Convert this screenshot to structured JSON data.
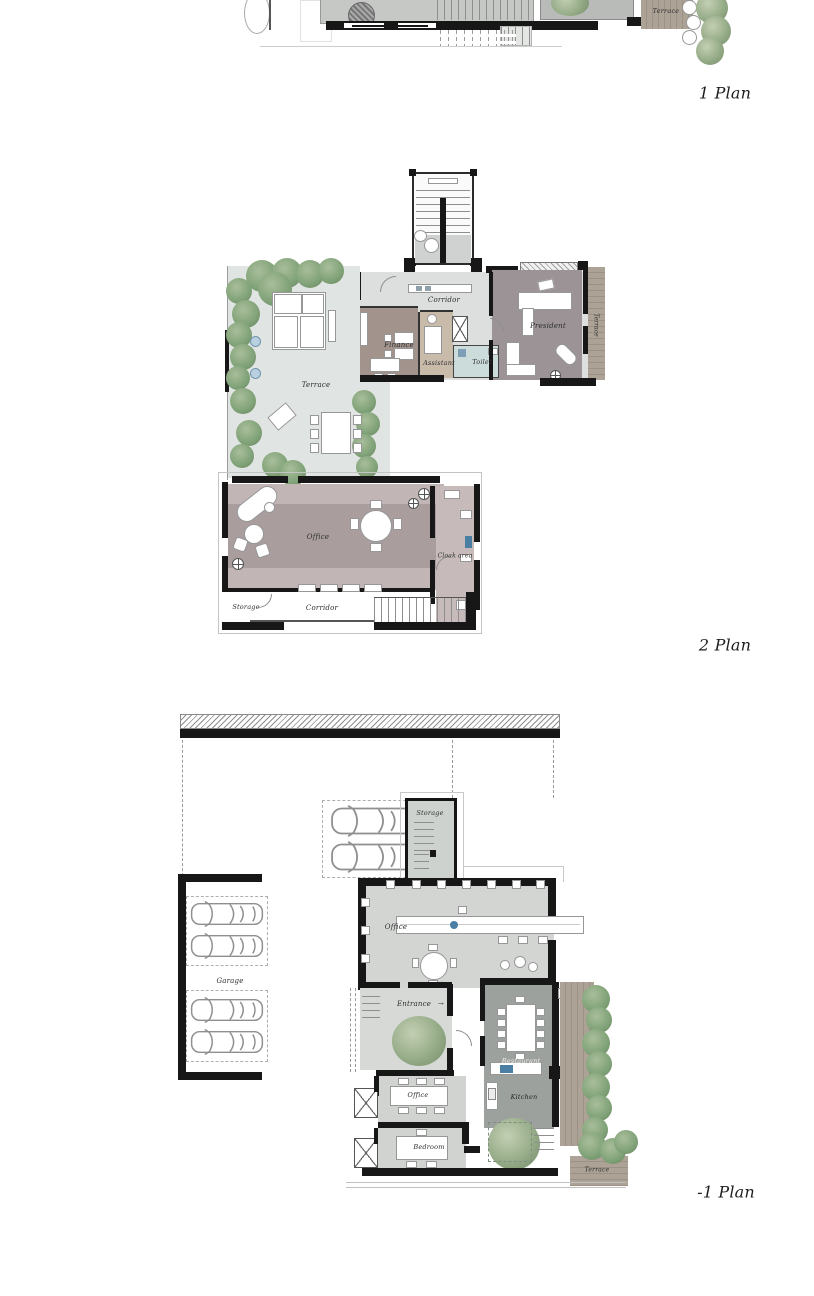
{
  "page": {
    "background": "#ffffff"
  },
  "plan1": {
    "label": "1 Plan",
    "rooms": {
      "terrace": "Terrace"
    }
  },
  "plan2": {
    "label": "2 Plan",
    "rooms": {
      "corridor": "Corridor",
      "finance": "Finance",
      "assistant": "Assistant",
      "toilet": "Toilet",
      "president": "President",
      "terraceRight": "Terrace",
      "terraceLeft": "Terrace",
      "office": "Office",
      "cloakArea": "Cloak area",
      "storage": "Storage",
      "corridorBottom": "Corridor"
    }
  },
  "planM1": {
    "label": "-1 Plan",
    "rooms": {
      "storage": "Storage",
      "office": "Office",
      "garage": "Garage",
      "entrance": "Entrance",
      "restaurant": "Restaurant",
      "kitchen": "Kitchen",
      "officeSmall": "Office",
      "bedroom": "Bedroom",
      "terrace": "Terrace"
    }
  },
  "icons": {
    "entrance_arrow": "→"
  },
  "colors": {
    "walls": "#171717",
    "floor_light": "#dcdfdd",
    "terrace_floor": "#e0e4e2",
    "office_mauve_light": "#c2b5b5",
    "office_mauve_dark": "#aa9d9e",
    "finance_brown": "#a2948c",
    "assistant_tan": "#c8bbaa",
    "toilet_blue": "#ccdcdb",
    "president_gray": "#9c9397",
    "restaurant_gray": "#9da19d",
    "hall_gray": "#d2d5d2",
    "deck_wood": "#a59c92",
    "tree_green": "#8fa584",
    "accent_blue": "#4a7ea3"
  }
}
